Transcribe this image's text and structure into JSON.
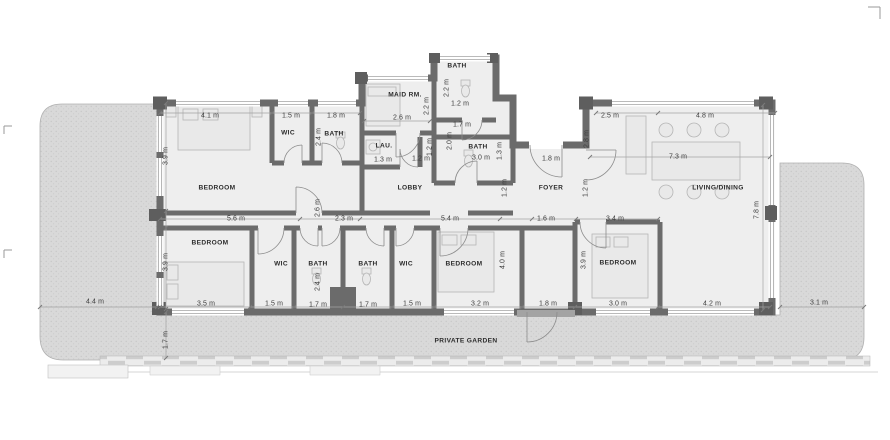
{
  "meta": {
    "title": "Apartment floor plan with private garden",
    "units": "m"
  },
  "palette": {
    "wall": "#6b6b6b",
    "column": "#5e5e5e",
    "floor": "#eeeeee",
    "garden": "#d9d9d9",
    "garden_dot": "#c6c6c6",
    "dim_line": "#a3a3a3",
    "furniture": "#b5b5b5",
    "room_text": "#2c2c2c",
    "dim_text": "#3c3c3c"
  },
  "plan": {
    "rooms": [
      {
        "id": "room-bedroom-top-left",
        "label": "BEDROOM",
        "x": 217,
        "y": 188
      },
      {
        "id": "room-wic-top",
        "label": "WIC",
        "x": 288,
        "y": 133
      },
      {
        "id": "room-bath-top-left",
        "label": "BATH",
        "x": 334,
        "y": 134
      },
      {
        "id": "room-maid-rm",
        "label": "MAID RM.",
        "x": 405,
        "y": 95
      },
      {
        "id": "room-bath-top-middle",
        "label": "BATH",
        "x": 457,
        "y": 66
      },
      {
        "id": "room-laundry",
        "label": "LAU.",
        "x": 384,
        "y": 146
      },
      {
        "id": "room-lobby",
        "label": "LOBBY",
        "x": 410,
        "y": 188
      },
      {
        "id": "room-bath-middle",
        "label": "BATH",
        "x": 478,
        "y": 147
      },
      {
        "id": "room-foyer",
        "label": "FOYER",
        "x": 551,
        "y": 188
      },
      {
        "id": "room-living-dining",
        "label": "LIVING/DINING",
        "x": 718,
        "y": 188
      },
      {
        "id": "room-bedroom-bottom-left",
        "label": "BEDROOM",
        "x": 210,
        "y": 243
      },
      {
        "id": "room-wic-bottom-left",
        "label": "WIC",
        "x": 281,
        "y": 264
      },
      {
        "id": "room-bath-bottom-left",
        "label": "BATH",
        "x": 318,
        "y": 264
      },
      {
        "id": "room-bath-bottom-right",
        "label": "BATH",
        "x": 368,
        "y": 264
      },
      {
        "id": "room-wic-bottom-right",
        "label": "WIC",
        "x": 406,
        "y": 264
      },
      {
        "id": "room-bedroom-bottom-center",
        "label": "BEDROOM",
        "x": 464,
        "y": 264
      },
      {
        "id": "room-bedroom-bottom-right",
        "label": "BEDROOM",
        "x": 618,
        "y": 263
      },
      {
        "id": "label-private-garden",
        "label": "PRIVATE GARDEN",
        "x": 466,
        "y": 341
      }
    ],
    "dims_h": [
      {
        "text": "4.1 m",
        "x": 210,
        "y": 116
      },
      {
        "text": "1.5 m",
        "x": 291,
        "y": 116
      },
      {
        "text": "1.8 m",
        "x": 336,
        "y": 116
      },
      {
        "text": "2.6 m",
        "x": 402,
        "y": 118
      },
      {
        "text": "1.2 m",
        "x": 460,
        "y": 104
      },
      {
        "text": "1.7 m",
        "x": 462,
        "y": 125
      },
      {
        "text": "2.5 m",
        "x": 610,
        "y": 116
      },
      {
        "text": "4.8 m",
        "x": 705,
        "y": 116
      },
      {
        "text": "1.3 m",
        "x": 383,
        "y": 160
      },
      {
        "text": "1.2 m",
        "x": 421,
        "y": 159
      },
      {
        "text": "3.0 m",
        "x": 481,
        "y": 158
      },
      {
        "text": "1.8 m",
        "x": 551,
        "y": 159
      },
      {
        "text": "7.3 m",
        "x": 678,
        "y": 157
      },
      {
        "text": "5.6 m",
        "x": 236,
        "y": 219
      },
      {
        "text": "2.3 m",
        "x": 344,
        "y": 219
      },
      {
        "text": "5.4 m",
        "x": 450,
        "y": 219
      },
      {
        "text": "1.6 m",
        "x": 546,
        "y": 219
      },
      {
        "text": "3.4 m",
        "x": 615,
        "y": 219
      },
      {
        "text": "3.5 m",
        "x": 206,
        "y": 304
      },
      {
        "text": "1.5 m",
        "x": 274,
        "y": 304
      },
      {
        "text": "1.7 m",
        "x": 318,
        "y": 305
      },
      {
        "text": "1.7 m",
        "x": 368,
        "y": 305
      },
      {
        "text": "1.5 m",
        "x": 412,
        "y": 304
      },
      {
        "text": "3.2 m",
        "x": 480,
        "y": 304
      },
      {
        "text": "1.8 m",
        "x": 548,
        "y": 304
      },
      {
        "text": "3.0 m",
        "x": 618,
        "y": 304
      },
      {
        "text": "4.2 m",
        "x": 712,
        "y": 304
      },
      {
        "text": "4.4 m",
        "x": 95,
        "y": 302
      },
      {
        "text": "3.1 m",
        "x": 819,
        "y": 303
      }
    ],
    "dims_v": [
      {
        "text": "3.9 m",
        "x": 166,
        "y": 156
      },
      {
        "text": "3.9 m",
        "x": 166,
        "y": 262
      },
      {
        "text": "2.4 m",
        "x": 319,
        "y": 137
      },
      {
        "text": "2.2 m",
        "x": 427,
        "y": 106
      },
      {
        "text": "2.2 m",
        "x": 447,
        "y": 88
      },
      {
        "text": "1.2 m",
        "x": 430,
        "y": 147
      },
      {
        "text": "2.0 m",
        "x": 450,
        "y": 141
      },
      {
        "text": "1.3 m",
        "x": 500,
        "y": 151
      },
      {
        "text": "2.8 m",
        "x": 587,
        "y": 139
      },
      {
        "text": "1.2 m",
        "x": 505,
        "y": 188
      },
      {
        "text": "1.2 m",
        "x": 586,
        "y": 188
      },
      {
        "text": "2.6 m",
        "x": 318,
        "y": 208
      },
      {
        "text": "2.4 m",
        "x": 318,
        "y": 282
      },
      {
        "text": "4.0 m",
        "x": 503,
        "y": 260
      },
      {
        "text": "3.9 m",
        "x": 584,
        "y": 260
      },
      {
        "text": "7.8 m",
        "x": 757,
        "y": 210
      },
      {
        "text": "1.7 m",
        "x": 166,
        "y": 340
      }
    ]
  }
}
